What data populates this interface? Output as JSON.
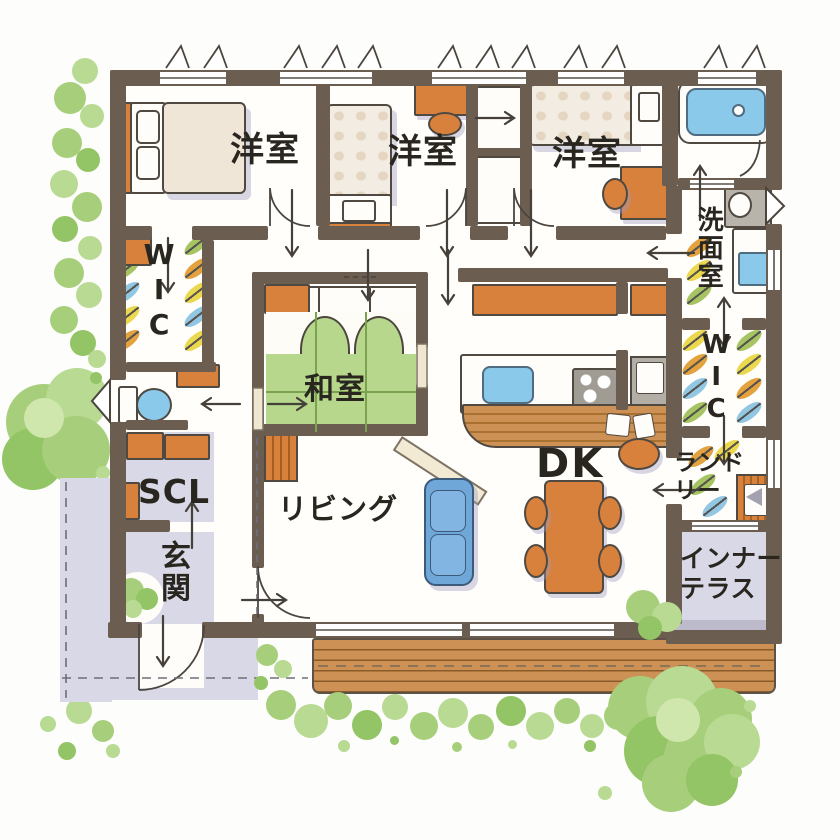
{
  "plan": {
    "type": "residential-floor-plan",
    "rooms": {
      "bedroom_top_left": {
        "label": "洋室"
      },
      "bedroom_top_mid": {
        "label": "洋室"
      },
      "bedroom_top_right": {
        "label": "洋室"
      },
      "wic_left": {
        "label": "WIC"
      },
      "washroom": {
        "label": "洗面室"
      },
      "wic_right": {
        "label": "WIC"
      },
      "japanese_room": {
        "label": "和室"
      },
      "living": {
        "label": "リビング"
      },
      "dining_kitchen": {
        "label": "DK"
      },
      "scl": {
        "label": "SCL"
      },
      "entrance": {
        "label": "玄関"
      },
      "laundry": {
        "label": "ランドリー"
      },
      "inner_terrace": {
        "label": "インナーテラス"
      }
    },
    "colors": {
      "wall": "#6b5d4f",
      "tatami_green": "#b7d78c",
      "wood_orange": "#d8813d",
      "water_blue": "#8ac9ea",
      "floor_gray": "#d9d8e6",
      "deck_wood": "#cd9055",
      "foliage_green": "#a7cf7b"
    }
  }
}
